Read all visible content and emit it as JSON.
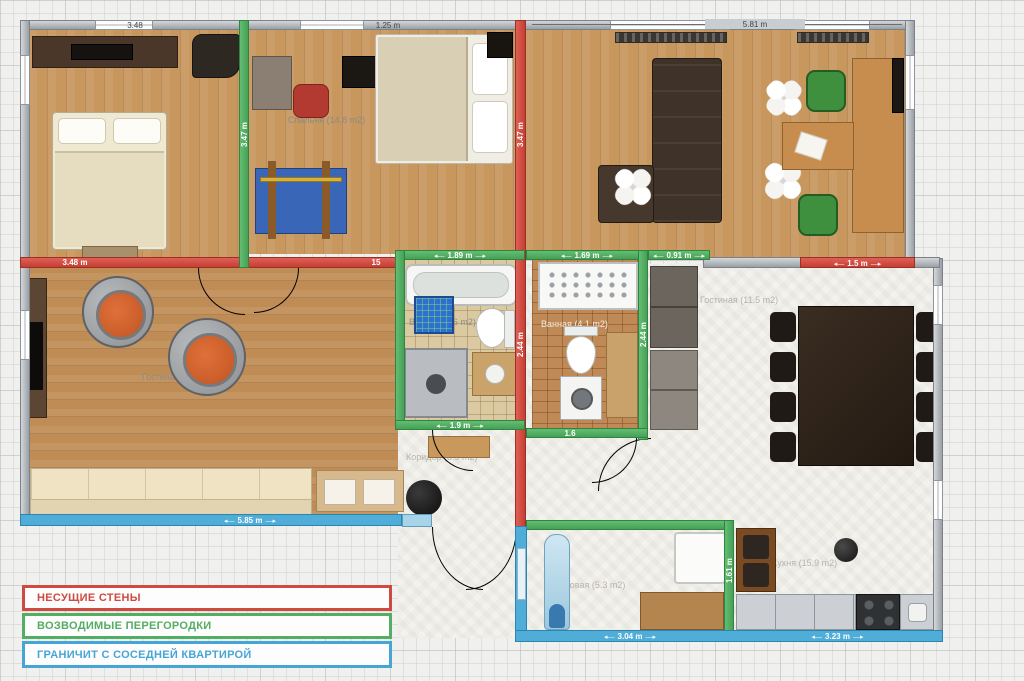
{
  "colors": {
    "load_bearing_wall": "#c43e33",
    "partition_wall": "#46a055",
    "neighbor_wall": "#4fadd8",
    "outer_wall": "#9aa0a6",
    "wood_floor": "#c7975e",
    "grid_bg": "#f0f0ee"
  },
  "legend": {
    "items": [
      {
        "label": "НЕСУЩИЕ СТЕНЫ",
        "color": "#cf4a40"
      },
      {
        "label": "ВОЗВОДИМЫЕ ПЕРЕГОРОДКИ",
        "color": "#53ad63"
      },
      {
        "label": "ГРАНИЧИТ С СОСЕДНЕЙ КВАРТИРОЙ",
        "color": "#45a6d6"
      }
    ]
  },
  "rooms": [
    {
      "label": "Спальня (14.8 m2)"
    },
    {
      "label": "Гостиная (23.9 m2)"
    },
    {
      "label": "Ванная (4.6 m2)"
    },
    {
      "label": "Ванная (4.1 m2)"
    },
    {
      "label": "Гостиная (11.5 m2)"
    },
    {
      "label": "Коридор (8.9 m2)"
    },
    {
      "label": "Кладовая (5.3 m2)"
    },
    {
      "label": "Кухня (15.9 m2)"
    }
  ],
  "dims": [
    {
      "label": "3.48"
    },
    {
      "label": "1.25 m"
    },
    {
      "label": "5.81 m"
    },
    {
      "label": "3.48 m"
    },
    {
      "label": "15"
    },
    {
      "label": "1.89 m"
    },
    {
      "label": "1.69 m"
    },
    {
      "label": "0.91 m"
    },
    {
      "label": "1.5 m"
    },
    {
      "label": "3.47 m"
    },
    {
      "label": "3.47 m"
    },
    {
      "label": "2.44 m"
    },
    {
      "label": "2.44 m"
    },
    {
      "label": "1.9 m"
    },
    {
      "label": "1.6"
    },
    {
      "label": "5.85 m"
    },
    {
      "label": "3.04 m"
    },
    {
      "label": "3.23 m"
    },
    {
      "label": "1.61 m"
    }
  ]
}
